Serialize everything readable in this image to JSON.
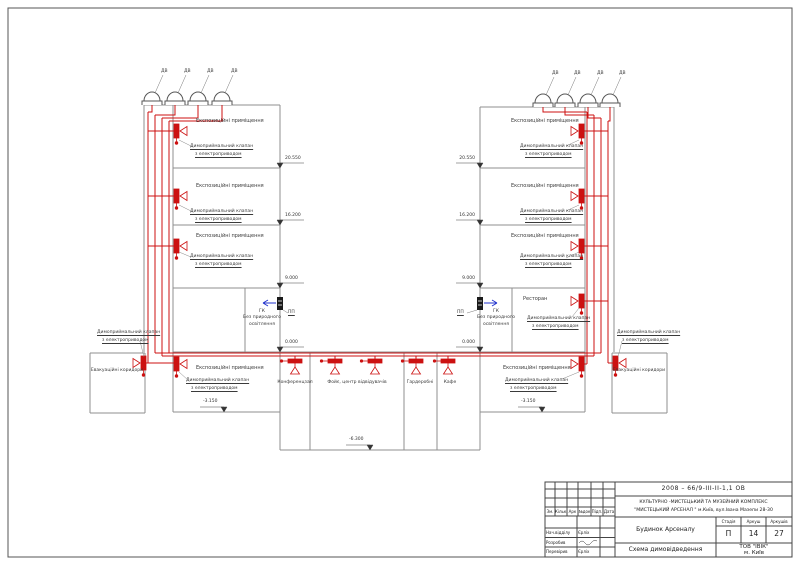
{
  "diagram": {
    "fan": "ДВ",
    "exhibition": "Експозиційні приміщення",
    "valve1": "Димоприймальний клапан",
    "valve2": "з електроприводом",
    "gk": "ГК",
    "nolight1": "Без природного",
    "nolight2": "освітлення",
    "pp": "ПП",
    "restaurant": "Ресторан",
    "conference": "Конференцзал",
    "foyer": "Фойє, центр відвідувачів",
    "wardrobe": "Гардеробні",
    "cafe": "Кафе",
    "evac": "Евакуаційні коридори",
    "e20": "20.550",
    "e16": "16.200",
    "e9": "9.000",
    "e0": "0.000",
    "em3": "-3.150",
    "em6": "-6.300",
    "colors": {
      "pipe": "#cc1111",
      "flow_arrow": "#2233cc",
      "walls": "#8f8f8f"
    }
  },
  "titleblock": {
    "doc_number": "2008 – 66/9-ІІІ-ІІ-1,1 ОВ",
    "project_line1": "КУЛЬТУРНО -МИСТЕЦЬКИЙ  ТА МУЗЕЙНИЙ  КОМПЛЕКС",
    "project_line2": "\"МИСТЕЦЬКИЙ  АРСЕНАЛ \" м.Київ, вул.Івана Мазепи 28-30",
    "object_name": "Будинок Арсеналу",
    "sheet_name": "Схема димовідведення",
    "company": "ТОВ \"ІВІК\"",
    "city": "м. Київ",
    "stage_label": "Стадія",
    "sheet_label": "Аркуш",
    "sheets_label": "Аркушів",
    "stage_value": "П",
    "sheet_value": "14",
    "sheets_value": "27",
    "col_zm": "Зм.",
    "col_kilk": "Кільк.",
    "col_ark": "Арк",
    "col_doc": "№док",
    "col_pidp": "Підп.",
    "col_data": "Дата",
    "row1_role": "Нач.відділу",
    "row1_name": "Єрліх",
    "row2_role": "Розробив",
    "row3_role": "Перевірив",
    "row3_name": "Єрліх"
  }
}
